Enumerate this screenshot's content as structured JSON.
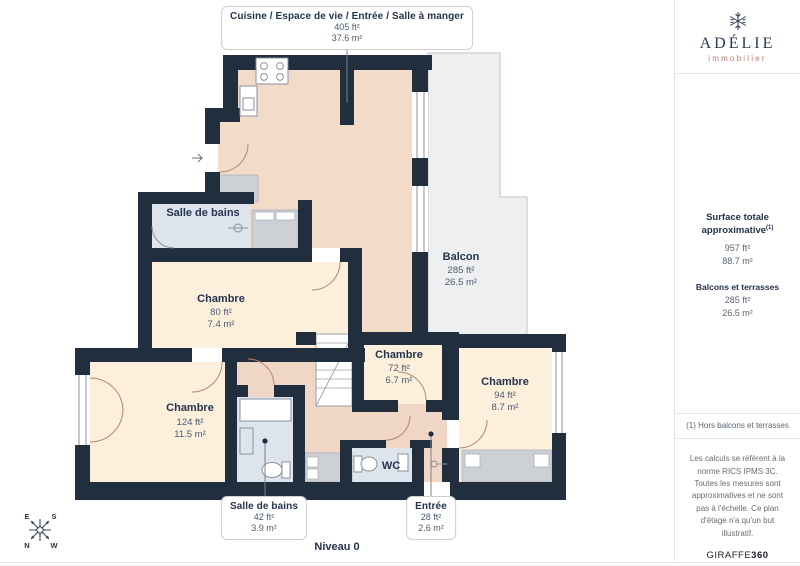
{
  "plan": {
    "level_label": "Niveau 0",
    "callouts": {
      "kitchen": {
        "title": "Cuisine / Espace de vie / Entrée / Salle à manger",
        "ft": "405 ft²",
        "m": "37.6 m²"
      },
      "bathroom": {
        "title": "Salle de bains",
        "ft": "42 ft²",
        "m": "3.9 m²"
      },
      "entry": {
        "title": "Entrée",
        "ft": "28 ft²",
        "m": "2.6 m²"
      }
    },
    "rooms": {
      "balcony": {
        "name": "Balcon",
        "ft": "285 ft²",
        "m": "26.5 m²"
      },
      "bathroom_top": {
        "name": "Salle de bains"
      },
      "bedroom_small": {
        "name": "Chambre",
        "ft": "80 ft²",
        "m": "7.4 m²"
      },
      "bedroom_mid": {
        "name": "Chambre",
        "ft": "72 ft²",
        "m": "6.7 m²"
      },
      "bedroom_right": {
        "name": "Chambre",
        "ft": "94 ft²",
        "m": "8.7 m²"
      },
      "bedroom_large": {
        "name": "Chambre",
        "ft": "124 ft²",
        "m": "11.5 m²"
      },
      "wc": {
        "name": "WC"
      }
    },
    "compass": {
      "e": "E",
      "s": "S",
      "n": "N",
      "w": "W"
    }
  },
  "sidebar": {
    "brand": {
      "name": "ADÉLIE",
      "tagline": "immobilier"
    },
    "surface": {
      "title": "Surface totale approximative",
      "sup": "(1)",
      "ft": "957 ft²",
      "m": "88.7 m²"
    },
    "balconies": {
      "title": "Balcons et terrasses",
      "ft": "285 ft²",
      "m": "26.5 m²"
    },
    "footnote": "(1) Hors balcons et terrasses",
    "disclaimer": "Les calculs se réfèrent à la norme RICS IPMS 3C. Toutes les mesures sont approximatives et ne sont pas à l'échelle. Ce plan d'étage n'a qu'un but illustratif.",
    "brand_footer": {
      "name": "GIRAFFE",
      "suffix": "360"
    }
  },
  "colors": {
    "wall": "#212e3e",
    "living": "#f3dbca",
    "bedroom": "#fcefdc",
    "bathroom": "#dde4ee",
    "closet": "#cdd1d6",
    "balcony": "#edeff0",
    "accent_text": "#24344c",
    "brand_red": "#c1786b"
  }
}
